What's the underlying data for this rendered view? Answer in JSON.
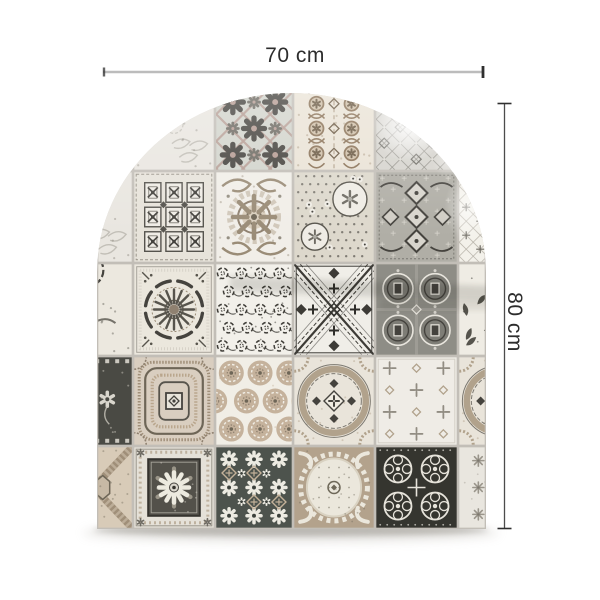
{
  "canvas": {
    "background": "#ffffff"
  },
  "annotations": {
    "width": {
      "label": "70 cm"
    },
    "height": {
      "label": "80 cm"
    },
    "line_color_light": "#bcbcbc",
    "line_color_dark": "#4c4c4c",
    "tick_color": "#2f2f2f",
    "text_color": "#2d2d2d"
  },
  "panel": {
    "description": "Arched patchwork panel of assorted vintage ornamental cement tiles in cream, taupe and charcoal",
    "shape": "arch",
    "grid": {
      "columns": 6,
      "rows": 5
    },
    "tile_motifs": [
      [
        "paleScroll",
        "paleScroll",
        "diamondLattice",
        "damaskBrown",
        "ornateLattice",
        "ornateLattice"
      ],
      [
        "paleScroll",
        "coffered",
        "baroqueMedallion",
        "chintz",
        "grayDamask",
        "diamondStarWhite"
      ],
      [
        "cornerFragment",
        "sunburst",
        "laceSwirl",
        "diagonalX",
        "quatrefoilGrid",
        "birdToile"
      ],
      [
        "toileStrip",
        "wovenSquare",
        "dotRosettes",
        "circleDiamond",
        "lightMotifGrid",
        "circleDiamond"
      ],
      [
        "diagGeo",
        "flowerFrame",
        "darkFlowers",
        "baroqueLight",
        "laceDark",
        "paleRosette"
      ]
    ],
    "tile_backgrounds": {
      "paleScroll": "#e9e6e0",
      "diamondLattice": "#d2d4cc",
      "damaskBrown": "#eae3d6",
      "ornateLattice": "#d6d4ce",
      "coffered": "#e7e3da",
      "baroqueMedallion": "#f1eee8",
      "chintz": "#ddd8cc",
      "grayDamask": "#b0aea6",
      "diamondStarWhite": "#f3f1ea",
      "cornerFragment": "#ece8df",
      "sunburst": "#ebe7dd",
      "laceSwirl": "#f2f0ea",
      "diagonalX": "#f0eee8",
      "quatrefoilGrid": "#8e8d86",
      "birdToile": "#efece4",
      "toileStrip": "#4a4a44",
      "wovenSquare": "#d9cec0",
      "dotRosettes": "#f1eee6",
      "circleDiamond": "#e9e4da",
      "lightMotifGrid": "#efece6",
      "diagGeo": "#d8cbb8",
      "flowerFrame": "#e5e1d8",
      "darkFlowers": "#4d534d",
      "baroqueLight": "#b3a28c",
      "laceDark": "#35352f",
      "paleRosette": "#e9e6df"
    },
    "palette": {
      "grout": "#c2beb7",
      "cream": "#ece9e1",
      "white": "#f3f1ea",
      "light_gray": "#d6d4cd",
      "mid_gray": "#b0aea6",
      "slate": "#8e8d86",
      "charcoal": "#45433e",
      "near_black": "#35342f",
      "taupe": "#a5967f",
      "warm_beige": "#c7b9a5",
      "dusty_rose": "#b59b92",
      "brown": "#8a7257",
      "light_on_dark": "#e6e3da",
      "tan": "#c3b199",
      "dark_olive": "#4d534d"
    }
  }
}
